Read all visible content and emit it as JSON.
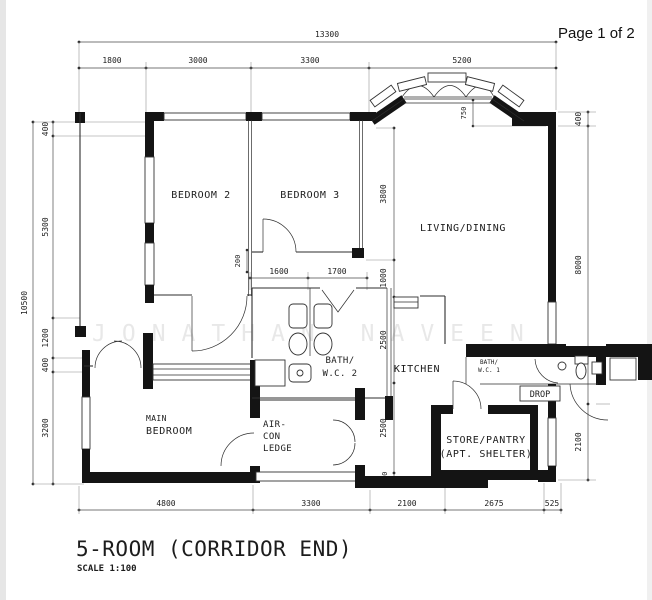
{
  "page_label": "Page 1 of 2",
  "plan_title": "5-ROOM (CORRIDOR END)",
  "scale_text": "SCALE  1:100",
  "watermark_text": "JONATHAN NAVEEN",
  "rooms": {
    "bedroom2": "BEDROOM 2",
    "bedroom3": "BEDROOM 3",
    "living": "LIVING/DINING",
    "kitchen": "KITCHEN",
    "bath2_line1": "BATH/",
    "bath2_line2": "W.C. 2",
    "bath1_line1": "BATH/",
    "bath1_line2": "W.C. 1",
    "main_line1": "MAIN",
    "main_line2": "BEDROOM",
    "aircon_line1": "AIR-",
    "aircon_line2": "CON",
    "aircon_line3": "LEDGE",
    "store_line1": "STORE/PANTRY",
    "store_line2": "(APT. SHELTER)",
    "drop": "DROP"
  },
  "dims": {
    "width_total": "13300",
    "height_total": "10500",
    "top": [
      "1800",
      "3000",
      "3300",
      "5200"
    ],
    "bottom": [
      "4800",
      "3300",
      "2100",
      "2675",
      "525"
    ],
    "left": [
      "400",
      "5300",
      "1200",
      "400",
      "3200"
    ],
    "right": [
      "400",
      "8000",
      "2100"
    ],
    "mid_vertical": [
      "3800",
      "1000",
      "2500",
      "2500",
      "300"
    ],
    "bath_width": [
      "1600",
      "1700"
    ],
    "offset_200": "200",
    "bay_depth": "750"
  }
}
